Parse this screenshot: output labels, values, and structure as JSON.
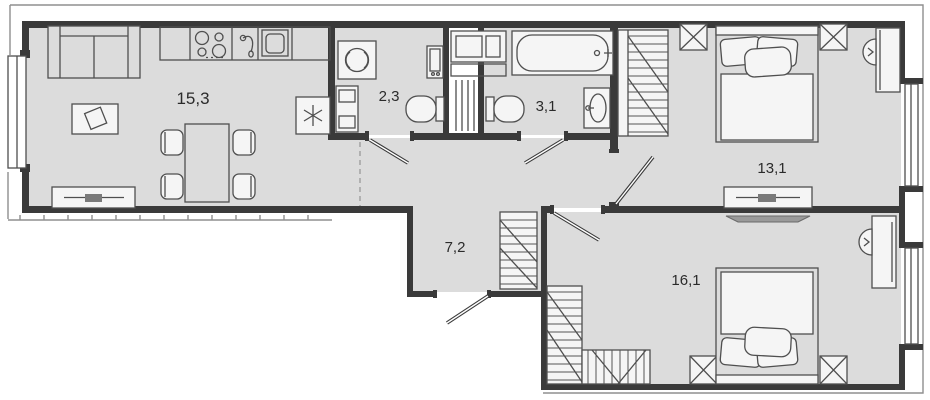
{
  "plan": {
    "type": "apartment-floor-plan",
    "room_labels": {
      "living_kitchen": "15,3",
      "bathroom_small": "2,3",
      "bathroom_large": "3,1",
      "bedroom_top": "13,1",
      "hallway": "7,2",
      "bedroom_bottom": "16,1"
    },
    "colors": {
      "floor": "#dcdcdc",
      "wall": "#3a3a3a",
      "furniture_line": "#4f4f4f",
      "exterior_line": "#8f8f8f",
      "background": "#ffffff"
    }
  }
}
